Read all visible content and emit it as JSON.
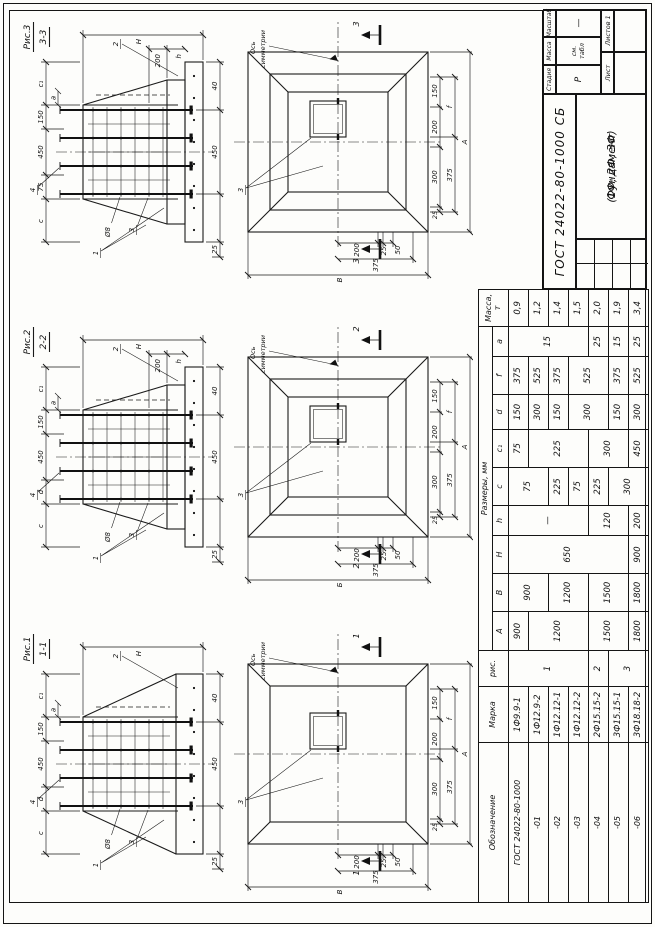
{
  "sheet": {
    "doc_code": "ГОСТ 24022-80-1000 СБ",
    "title_line1": "Фундамент",
    "title_line2": "(1Ф; 2Ф; 3Ф)",
    "stage_label": "Стадия",
    "mass_label": "Масса",
    "scale_label": "Масштаб",
    "stage_value": "Р",
    "mass_value": "см. табл",
    "scale_value": "—",
    "sheet_label": "Лист",
    "sheets_label": "Листов 1"
  },
  "spec_table": {
    "header": {
      "obozn": "Обозначение",
      "marka": "Марка",
      "ris": "рис.",
      "sizes": "Размеры, мм",
      "mass": "Масса, т",
      "dims": [
        "А",
        "В",
        "Н",
        "h",
        "c",
        "c₁",
        "d",
        "f",
        "а"
      ]
    },
    "rows": 7,
    "columns": [
      {
        "name": "obozn",
        "cells": [
          [
            "ГОСТ 24022-80-1000",
            1
          ],
          [
            "-01",
            1
          ],
          [
            "-02",
            1
          ],
          [
            "-03",
            1
          ],
          [
            "-04",
            1
          ],
          [
            "-05",
            1
          ],
          [
            "-06",
            1
          ]
        ]
      },
      {
        "name": "marka",
        "cells": [
          [
            "1Ф9.9-1",
            1
          ],
          [
            "1Ф12.9-2",
            1
          ],
          [
            "1Ф12.12-1",
            1
          ],
          [
            "1Ф12.12-2",
            1
          ],
          [
            "2Ф15.15-2",
            1
          ],
          [
            "3Ф15.15-1",
            1
          ],
          [
            "3Ф18.18-2",
            1
          ]
        ]
      },
      {
        "name": "ris",
        "cells": [
          [
            "1",
            4
          ],
          [
            "2",
            1
          ],
          [
            "3",
            2
          ]
        ]
      },
      {
        "name": "A",
        "cells": [
          [
            "900",
            1
          ],
          [
            "1200",
            3
          ],
          [
            "1500",
            2
          ],
          [
            "1800",
            1
          ]
        ]
      },
      {
        "name": "B",
        "cells": [
          [
            "900",
            2
          ],
          [
            "1200",
            2
          ],
          [
            "1500",
            2
          ],
          [
            "1800",
            1
          ]
        ]
      },
      {
        "name": "H",
        "cells": [
          [
            "650",
            6
          ],
          [
            "900",
            1
          ]
        ]
      },
      {
        "name": "h",
        "cells": [
          [
            "—",
            4
          ],
          [
            "120",
            2
          ],
          [
            "200",
            1
          ]
        ]
      },
      {
        "name": "c",
        "cells": [
          [
            "75",
            2
          ],
          [
            "225",
            1
          ],
          [
            "75",
            1
          ],
          [
            "225",
            1
          ],
          [
            "300",
            2
          ]
        ]
      },
      {
        "name": "c1",
        "cells": [
          [
            "75",
            1
          ],
          [
            "225",
            3
          ],
          [
            "300",
            2
          ],
          [
            "450",
            1
          ]
        ]
      },
      {
        "name": "d",
        "cells": [
          [
            "150",
            1
          ],
          [
            "300",
            1
          ],
          [
            "150",
            1
          ],
          [
            "300",
            2
          ],
          [
            "150",
            1
          ],
          [
            "300",
            1
          ]
        ]
      },
      {
        "name": "f",
        "cells": [
          [
            "375",
            1
          ],
          [
            "525",
            1
          ],
          [
            "375",
            1
          ],
          [
            "525",
            2
          ],
          [
            "375",
            1
          ],
          [
            "525",
            1
          ]
        ]
      },
      {
        "name": "a",
        "cells": [
          [
            "15",
            4
          ],
          [
            "25",
            1
          ],
          [
            "15",
            1
          ],
          [
            "25",
            1
          ]
        ]
      },
      {
        "name": "mass",
        "cells": [
          [
            "0,9",
            1
          ],
          [
            "1,2",
            1
          ],
          [
            "1,4",
            1
          ],
          [
            "1,5",
            1
          ],
          [
            "2,0",
            1
          ],
          [
            "1,9",
            1
          ],
          [
            "3,4",
            1
          ]
        ]
      }
    ]
  },
  "figures": [
    {
      "label": "Рис.1",
      "section_title": "1-1",
      "cut_label": "1",
      "flat": true,
      "stepped": false,
      "axis_line1": "Ось",
      "axis_line2": "симметрии",
      "sec_dims": {
        "top1": "c",
        "top2": "d",
        "top3": "450",
        "top4": "150",
        "top5": "c₁",
        "small": "а",
        "height": "Н",
        "step_200": "200",
        "step_h": "h",
        "bottom_25": "25",
        "bottom1": "450",
        "bottom2": "40"
      },
      "sec_callouts": {
        "c1": "1",
        "c2": "2",
        "c3": "3",
        "c4": "4",
        "rebar": "Ø8"
      },
      "plan_dims": {
        "l_small1": "200",
        "l_small2": "25",
        "l_small3": "50",
        "l_mid": "375",
        "l_total": "В",
        "b_small1": "25",
        "b_small2": "300",
        "b_small3": "200",
        "b_small4": "150",
        "b_mid1": "375",
        "b_mid2": "f",
        "b_total": "А"
      },
      "plan_callout": "3"
    },
    {
      "label": "Рис.2",
      "section_title": "2-2",
      "cut_label": "2",
      "flat": false,
      "stepped": true,
      "axis_line1": "Ось",
      "axis_line2": "симметрии",
      "sec_dims": {
        "top1": "c",
        "top2": "d",
        "top3": "450",
        "top4": "150",
        "top5": "c₁",
        "small": "а",
        "height": "Н",
        "step_200": "200",
        "step_h": "h",
        "bottom_25": "25",
        "bottom1": "450",
        "bottom2": "40"
      },
      "sec_callouts": {
        "c1": "1",
        "c2": "2",
        "c3": "3",
        "c4": "4",
        "rebar": "Ø8"
      },
      "plan_dims": {
        "l_small1": "200",
        "l_small2": "25",
        "l_small3": "50",
        "l_mid": "375",
        "l_total": "Б",
        "b_small1": "25",
        "b_small2": "300",
        "b_small3": "200",
        "b_small4": "150",
        "b_mid1": "375",
        "b_mid2": "f",
        "b_total": "А"
      },
      "plan_callout": "3"
    },
    {
      "label": "Рис.3",
      "section_title": "3-3",
      "cut_label": "3",
      "flat": false,
      "stepped": true,
      "axis_line1": "Ось",
      "axis_line2": "симметрии",
      "sec_dims": {
        "top1": "c",
        "top2": "75",
        "top3": "450",
        "top4": "150",
        "top5": "c₁",
        "small": "а",
        "height": "Н",
        "step_200": "200",
        "step_h": "h",
        "bottom_25": "25",
        "bottom1": "450",
        "bottom2": "40"
      },
      "sec_callouts": {
        "c1": "1",
        "c2": "2",
        "c3": "3",
        "c4": "4",
        "rebar": "Ø8"
      },
      "plan_dims": {
        "l_small1": "200",
        "l_small2": "25",
        "l_small3": "50",
        "l_mid": "375",
        "l_total": "В",
        "b_small1": "25",
        "b_small2": "300",
        "b_small3": "200",
        "b_small4": "150",
        "b_mid1": "375",
        "b_mid2": "f",
        "b_total": "А"
      },
      "plan_callout": "3"
    }
  ]
}
